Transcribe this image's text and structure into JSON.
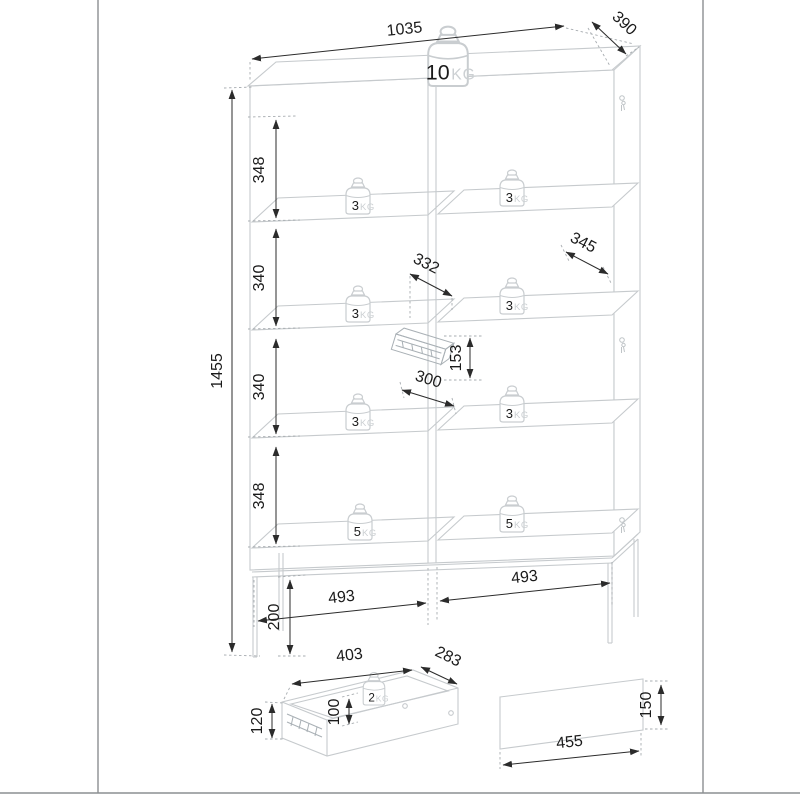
{
  "colors": {
    "furniture_line": "#c6cacd",
    "dimension_line": "#2b2b2b",
    "kg_label": "#ccd0d3",
    "page_border": "#8c8f92"
  },
  "weights": {
    "unit": "KG",
    "top": "10",
    "left_shelves": [
      "3",
      "3",
      "3",
      "5"
    ],
    "right_shelves": [
      "3",
      "3",
      "3",
      "5"
    ],
    "drawer": "2"
  },
  "dimensions": {
    "width": "1035",
    "depth": "390",
    "height": "1455",
    "sections": [
      "348",
      "340",
      "340",
      "348"
    ],
    "shelf_depth_left": "332",
    "shelf_depth_right": "345",
    "drawer_opening_height": "153",
    "drawer_opening_width": "300",
    "compartment_left": "493",
    "compartment_right": "493",
    "leg_height": "200",
    "drawer_detail": {
      "width": "403",
      "depth": "283",
      "height": "120",
      "inner_height": "100"
    },
    "front_panel": {
      "width": "455",
      "height": "150"
    }
  }
}
